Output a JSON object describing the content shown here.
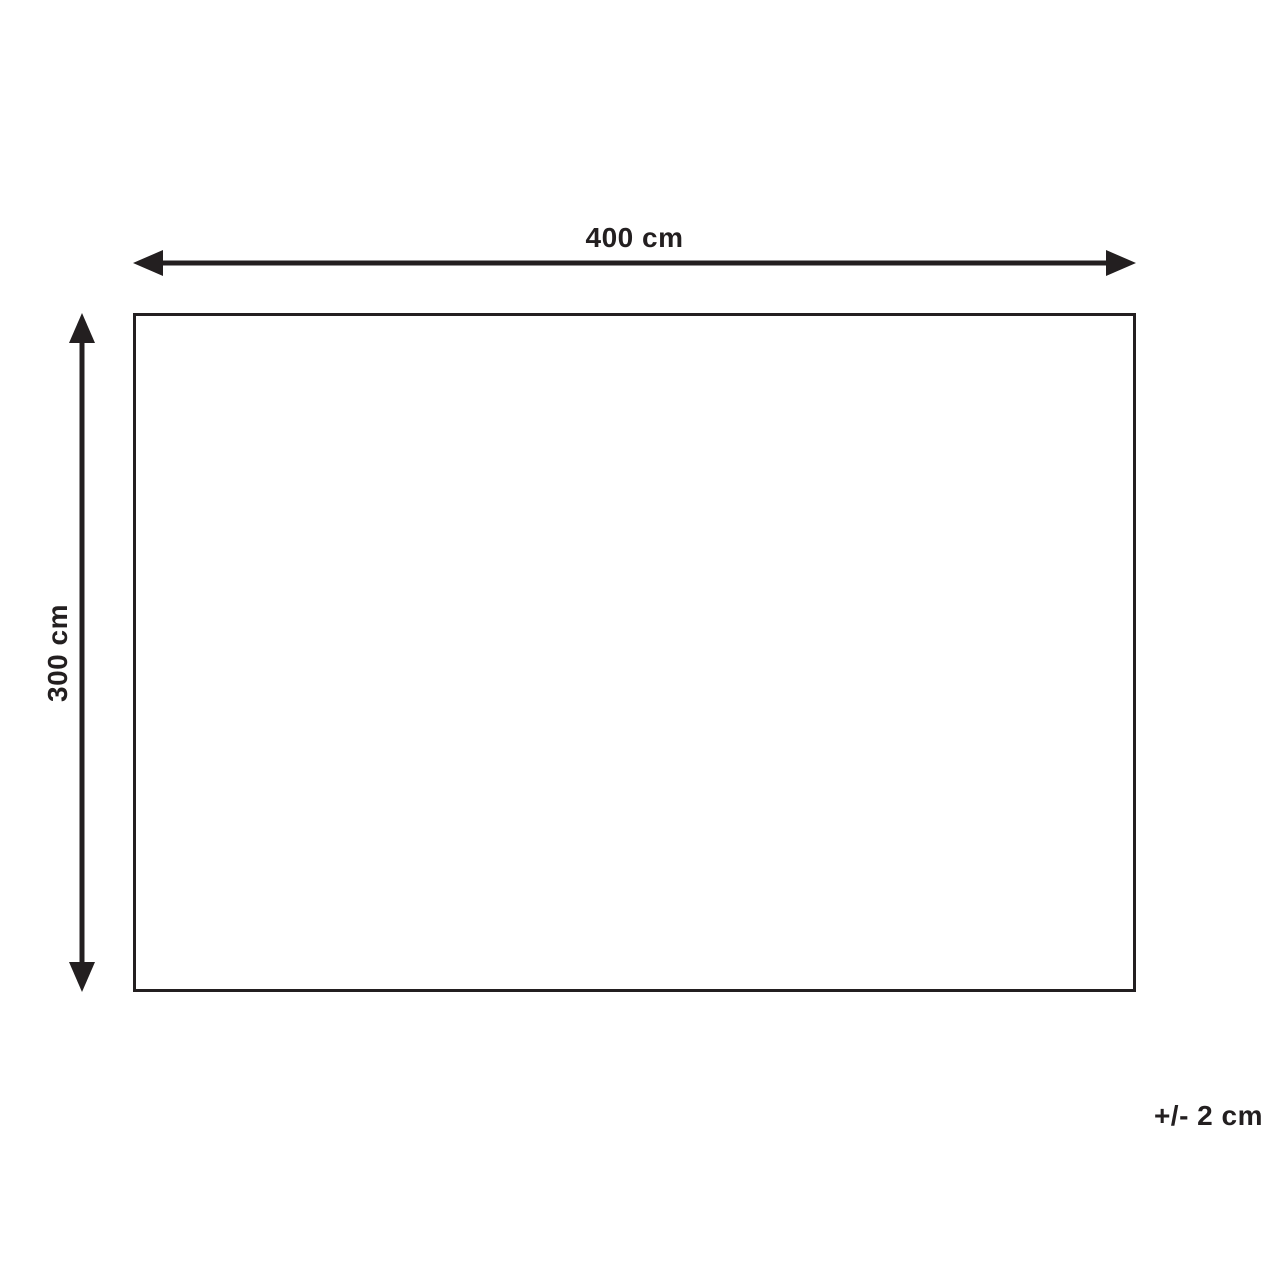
{
  "diagram": {
    "width_label": "400 cm",
    "height_label": "300 cm",
    "tolerance_label": "+/- 2 cm"
  },
  "colors": {
    "line": "#231f20",
    "background": "#ffffff"
  },
  "shape": {
    "type": "rectangle-outline",
    "width_cm": 400,
    "height_cm": 300,
    "tolerance_cm": 2
  }
}
